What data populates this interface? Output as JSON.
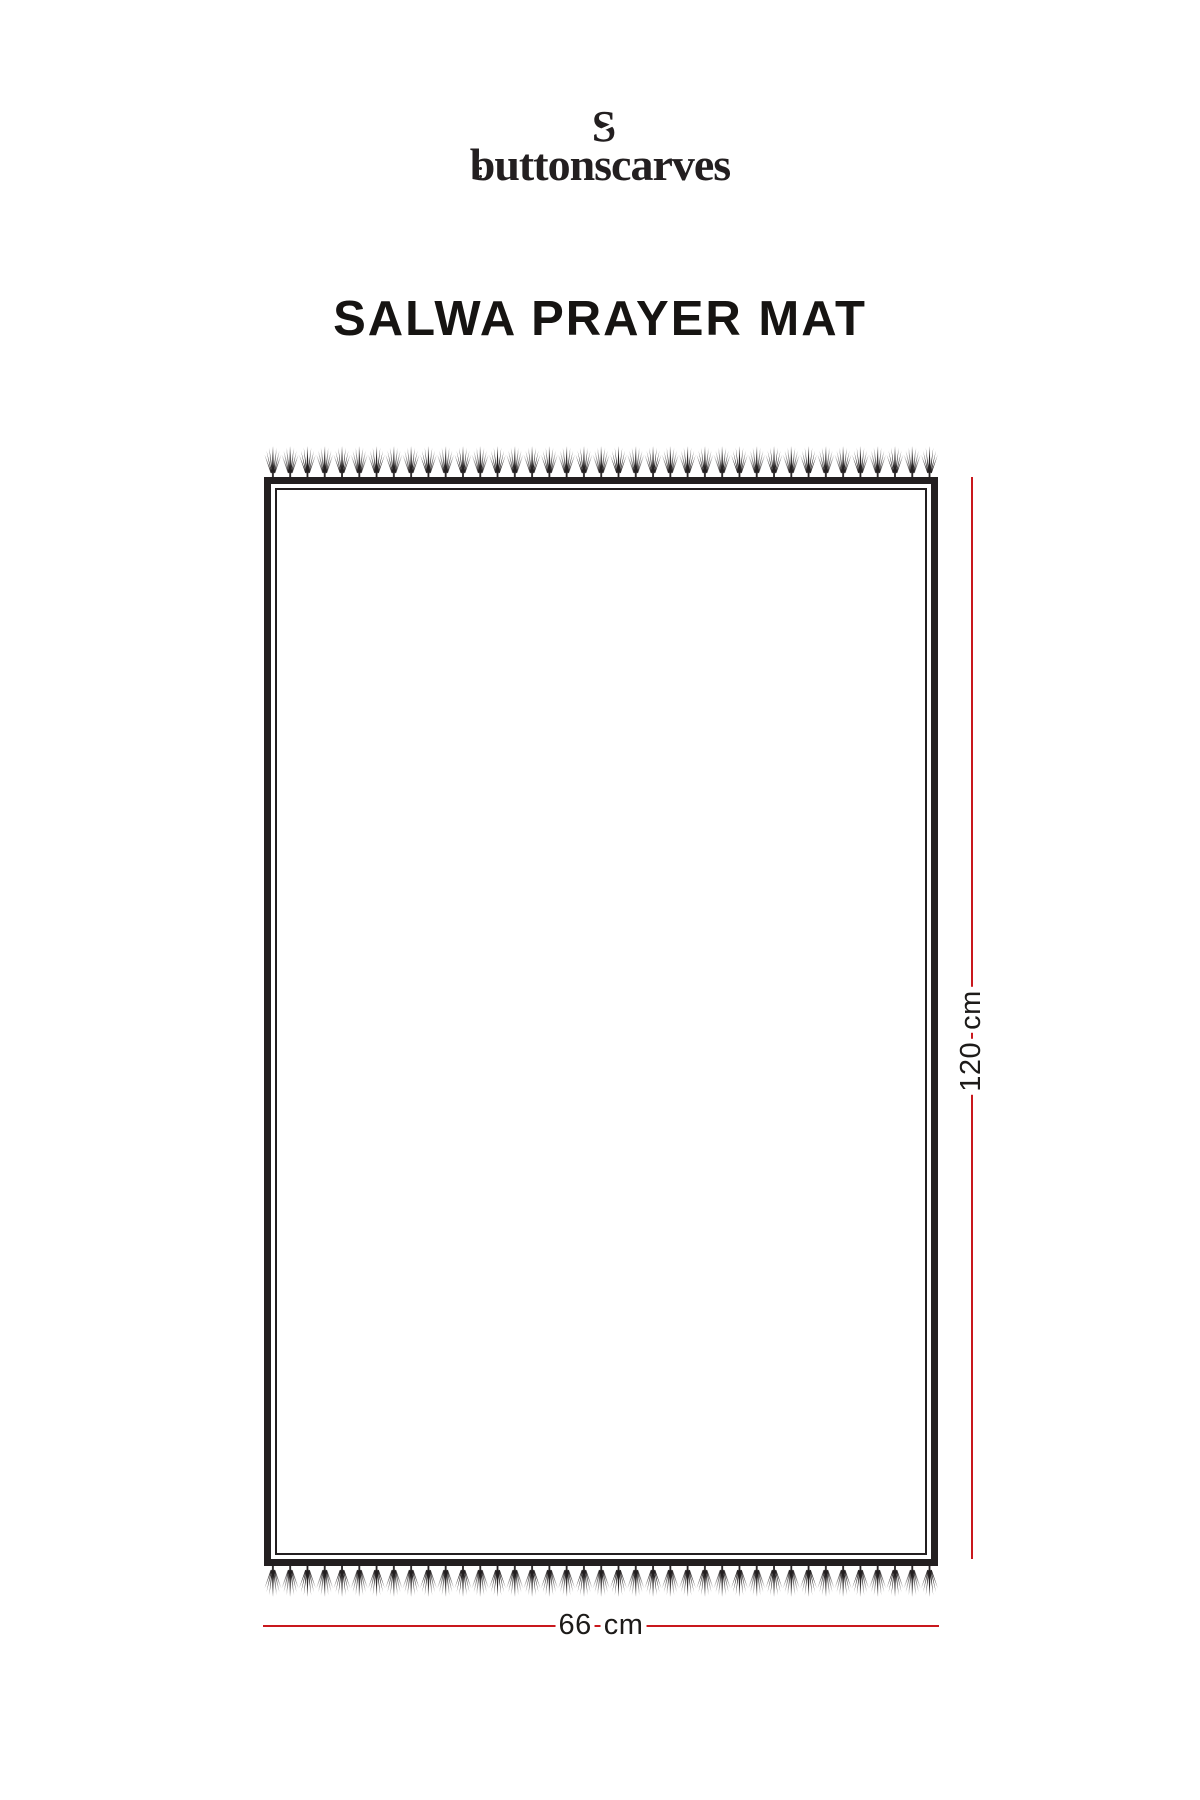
{
  "brand": {
    "monogram": "S",
    "wordmark": "buttonscarves"
  },
  "product": {
    "title": "SALWA PRAYER MAT"
  },
  "diagram": {
    "height_label": {
      "value": "120",
      "unit": "cm"
    },
    "width_label": {
      "value": "66",
      "unit": "cm"
    }
  },
  "colors": {
    "ink": "#231f20",
    "dimension_line": "#c9181d"
  }
}
